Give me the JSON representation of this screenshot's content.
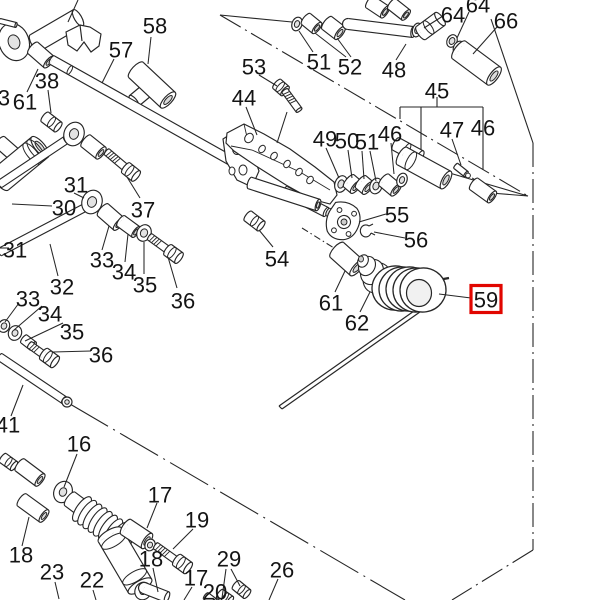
{
  "diagram": {
    "type": "exploded-parts-diagram",
    "background": "#ffffff",
    "line_color": "#262626",
    "highlight": {
      "text": "59",
      "box_color": "#e10600"
    },
    "labels": [
      {
        "t": "58",
        "x": 155,
        "y": 25
      },
      {
        "t": "57",
        "x": 121,
        "y": 49
      },
      {
        "t": "38",
        "x": 47,
        "y": 80
      },
      {
        "t": "61",
        "x": 25,
        "y": 101
      },
      {
        "t": "3",
        "x": 4,
        "y": 97
      },
      {
        "t": "53",
        "x": 254,
        "y": 66
      },
      {
        "t": "44",
        "x": 244,
        "y": 97
      },
      {
        "t": "51",
        "x": 319,
        "y": 61
      },
      {
        "t": "52",
        "x": 350,
        "y": 66
      },
      {
        "t": "48",
        "x": 394,
        "y": 69
      },
      {
        "t": "64",
        "x": 478,
        "y": 4
      },
      {
        "t": "64",
        "x": 453,
        "y": 14
      },
      {
        "t": "66",
        "x": 506,
        "y": 20
      },
      {
        "t": "45",
        "x": 437,
        "y": 90
      },
      {
        "t": "47",
        "x": 452,
        "y": 129
      },
      {
        "t": "46",
        "x": 483,
        "y": 127
      },
      {
        "t": "46",
        "x": 390,
        "y": 133
      },
      {
        "t": "49",
        "x": 325,
        "y": 138
      },
      {
        "t": "50",
        "x": 347,
        "y": 140
      },
      {
        "t": "51",
        "x": 367,
        "y": 141
      },
      {
        "t": "55",
        "x": 397,
        "y": 214
      },
      {
        "t": "56",
        "x": 416,
        "y": 239
      },
      {
        "t": "54",
        "x": 277,
        "y": 258
      },
      {
        "t": "31",
        "x": 76,
        "y": 184
      },
      {
        "t": "30",
        "x": 64,
        "y": 207
      },
      {
        "t": "37",
        "x": 143,
        "y": 209
      },
      {
        "t": "31",
        "x": 15,
        "y": 249
      },
      {
        "t": "33",
        "x": 102,
        "y": 259
      },
      {
        "t": "34",
        "x": 124,
        "y": 271
      },
      {
        "t": "35",
        "x": 145,
        "y": 284
      },
      {
        "t": "36",
        "x": 183,
        "y": 300
      },
      {
        "t": "32",
        "x": 62,
        "y": 286
      },
      {
        "t": "33",
        "x": 28,
        "y": 298
      },
      {
        "t": "34",
        "x": 50,
        "y": 313
      },
      {
        "t": "35",
        "x": 72,
        "y": 331
      },
      {
        "t": "36",
        "x": 101,
        "y": 354
      },
      {
        "t": "41",
        "x": 8,
        "y": 424
      },
      {
        "t": "16",
        "x": 79,
        "y": 443
      },
      {
        "t": "17",
        "x": 160,
        "y": 494
      },
      {
        "t": "19",
        "x": 197,
        "y": 519
      },
      {
        "t": "18",
        "x": 21,
        "y": 554
      },
      {
        "t": "23",
        "x": 52,
        "y": 571
      },
      {
        "t": "22",
        "x": 92,
        "y": 579
      },
      {
        "t": "18",
        "x": 151,
        "y": 558
      },
      {
        "t": "17",
        "x": 196,
        "y": 577
      },
      {
        "t": "20",
        "x": 215,
        "y": 591
      },
      {
        "t": "29",
        "x": 229,
        "y": 558
      },
      {
        "t": "26",
        "x": 282,
        "y": 569
      },
      {
        "t": "61",
        "x": 331,
        "y": 302
      },
      {
        "t": "62",
        "x": 357,
        "y": 322
      }
    ]
  }
}
